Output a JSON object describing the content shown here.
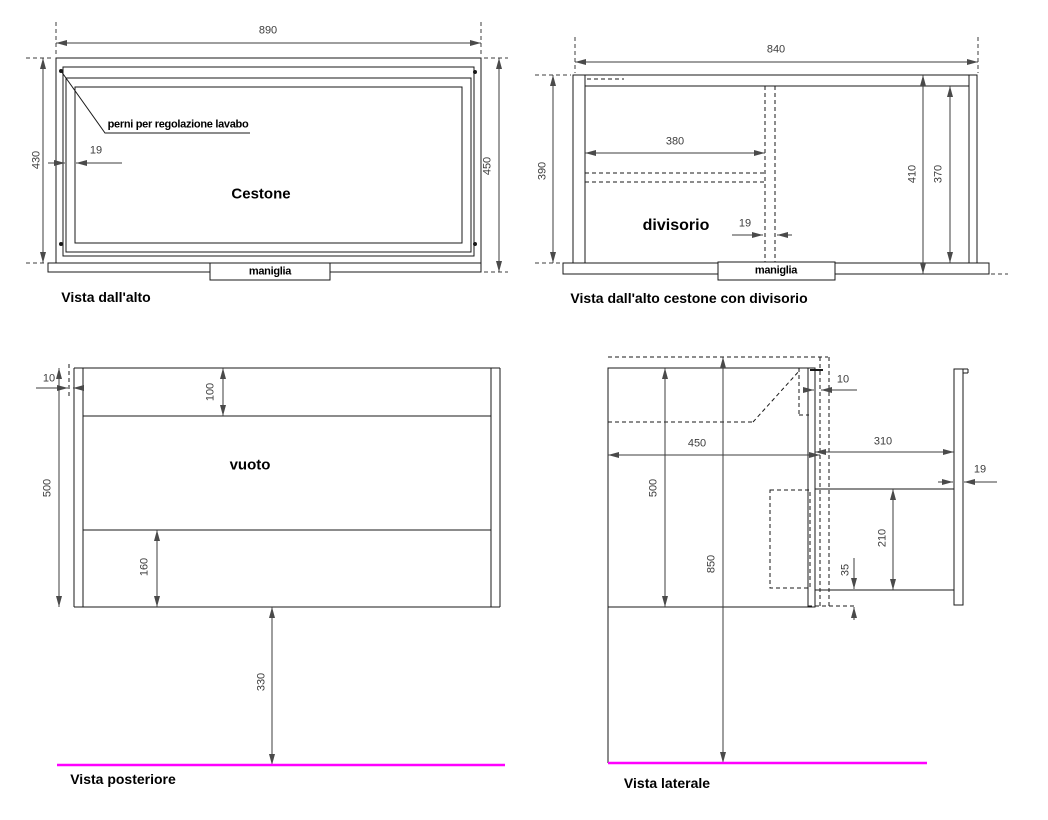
{
  "palette": {
    "bg": "#ffffff",
    "line": "#1a1a1a",
    "dim": "#3d3d3d",
    "floor": "#ff00ff"
  },
  "top_view": {
    "caption": "Vista dall'alto",
    "cestone": "Cestone",
    "maniglia": "maniglia",
    "perni": "perni per regolazione lavabo",
    "d890": "890",
    "d430": "430",
    "d450": "450",
    "d19": "19"
  },
  "divider_view": {
    "caption": "Vista dall'alto cestone con divisorio",
    "divisorio": "divisorio",
    "maniglia": "maniglia",
    "d840": "840",
    "d390": "390",
    "d380": "380",
    "d19": "19",
    "d410": "410",
    "d370": "370"
  },
  "rear_view": {
    "caption": "Vista posteriore",
    "vuoto": "vuoto",
    "d10": "10",
    "d100": "100",
    "d500": "500",
    "d160": "160",
    "d330": "330"
  },
  "side_view": {
    "caption": "Vista laterale",
    "d450": "450",
    "d310": "310",
    "d10": "10",
    "d19": "19",
    "d500": "500",
    "d850": "850",
    "d210": "210",
    "d35": "35"
  }
}
